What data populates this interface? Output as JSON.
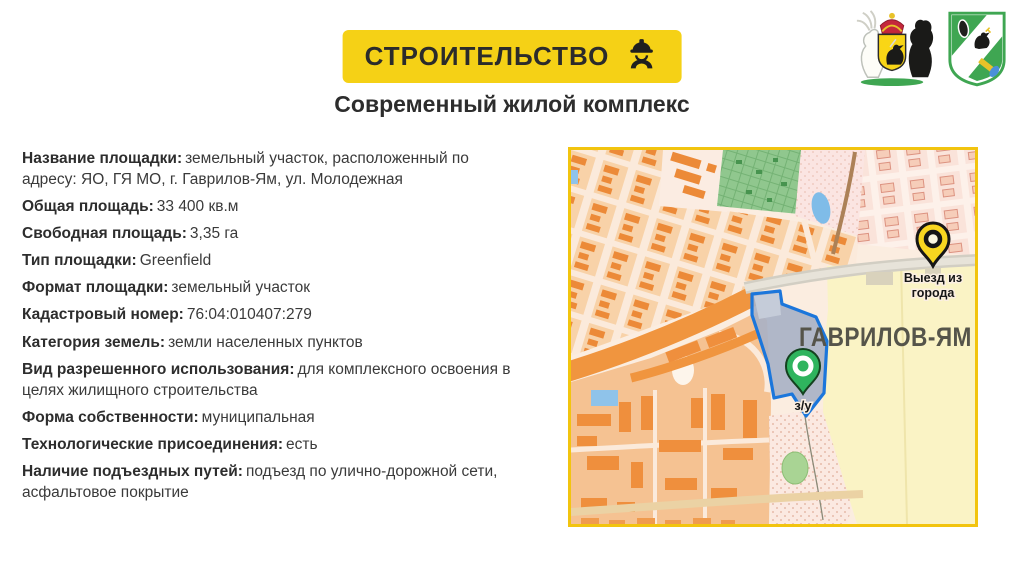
{
  "header": {
    "badge": {
      "label": "СТРОИТЕЛЬСТВО",
      "icon": "construction-worker-icon",
      "bg_color": "#F5D116",
      "text_color": "#2B2B2B"
    },
    "title": "Современный жилой комплекс",
    "emblems": [
      {
        "icon": "yaroslavl-region-coat-of-arms-icon"
      },
      {
        "icon": "gavrilov-yam-district-coat-of-arms-icon"
      }
    ]
  },
  "details": {
    "items": [
      {
        "label": "Название площадки:",
        "value": "земельный участок, расположенный по адресу: ЯО, ГЯ МО, г. Гаврилов-Ям, ул. Молодежная"
      },
      {
        "label": "Общая площадь:",
        "value": "33 400 кв.м"
      },
      {
        "label": "Свободная площадь:",
        "value": "3,35 га"
      },
      {
        "label": "Тип площадки:",
        "value": "Greenfield"
      },
      {
        "label": "Формат площадки:",
        "value": "земельный участок"
      },
      {
        "label": "Кадастровый номер:",
        "value": "76:04:010407:279"
      },
      {
        "label": "Категория земель:",
        "value": "земли населенных пунктов"
      },
      {
        "label": "Вид разрешенного использования:",
        "value": "для комплексного освоения в целях жилищного строительства"
      },
      {
        "label": "Форма собственности:",
        "value": "муниципальная"
      },
      {
        "label": "Технологические присоединения:",
        "value": "есть"
      },
      {
        "label": "Наличие подъездных путей:",
        "value": "подъезд по улично-дорожной сети, асфальтовое покрытие"
      }
    ]
  },
  "map": {
    "border_color": "#F2C40F",
    "city_label": "ГАВРИЛОВ-ЯМ",
    "land_plot": {
      "outline_color": "#1B76DB",
      "fill_color": "#A9B2C6"
    },
    "markers": [
      {
        "id": "city-exit",
        "icon": "map-pin-icon",
        "pin_color": "#F8D620",
        "label_lines": [
          "Выезд из",
          "города"
        ]
      },
      {
        "id": "land-plot",
        "icon": "map-pin-icon",
        "pin_color": "#2FB45E",
        "label_lines": [
          "з/у"
        ]
      }
    ]
  }
}
